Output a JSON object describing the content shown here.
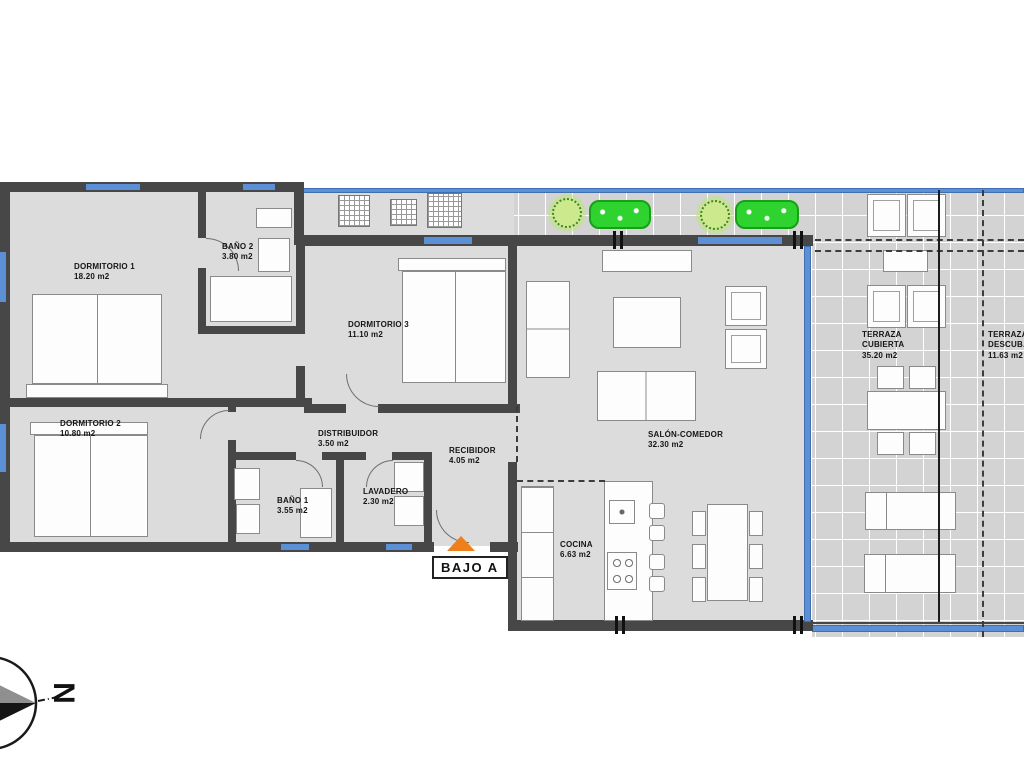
{
  "plan": {
    "unit": {
      "label": "BAJO A"
    },
    "compass": {
      "letter": "N"
    },
    "rooms": [
      {
        "id": "dormitorio-1",
        "name": "DORMITORIO 1",
        "area": "18.20 m2"
      },
      {
        "id": "bano-2",
        "name": "BAÑO 2",
        "area": "3.80 m2"
      },
      {
        "id": "dormitorio-3",
        "name": "DORMITORIO 3",
        "area": "11.10 m2"
      },
      {
        "id": "dormitorio-2",
        "name": "DORMITORIO 2",
        "area": "10.80 m2"
      },
      {
        "id": "bano-1",
        "name": "BAÑO 1",
        "area": "3.55 m2"
      },
      {
        "id": "lavadero",
        "name": "LAVADERO",
        "area": "2.30 m2"
      },
      {
        "id": "distribuidor",
        "name": "DISTRIBUIDOR",
        "area": "3.50 m2"
      },
      {
        "id": "recibidor",
        "name": "RECIBIDOR",
        "area": "4.05 m2"
      },
      {
        "id": "salon-comedor",
        "name": "SALÓN-COMEDOR",
        "area": "32.30 m2"
      },
      {
        "id": "cocina",
        "name": "COCINA",
        "area": "6.63 m2"
      },
      {
        "id": "terraza-cubierta",
        "name": "TERRAZA CUBIERTA",
        "area": "35.20 m2"
      },
      {
        "id": "terraza-descubierta",
        "name": "TERRAZA DESCUB.",
        "area": "11.63 m2"
      }
    ],
    "colors": {
      "wall": "#474747",
      "window": "#5b8fd6",
      "floor": "#dcdcdc",
      "terrace_tile": "#d3d3d3",
      "plant_light": "#cde98e",
      "plant_dark": "#2fd32f",
      "entrance_arrow": "#ef7f1a"
    }
  }
}
